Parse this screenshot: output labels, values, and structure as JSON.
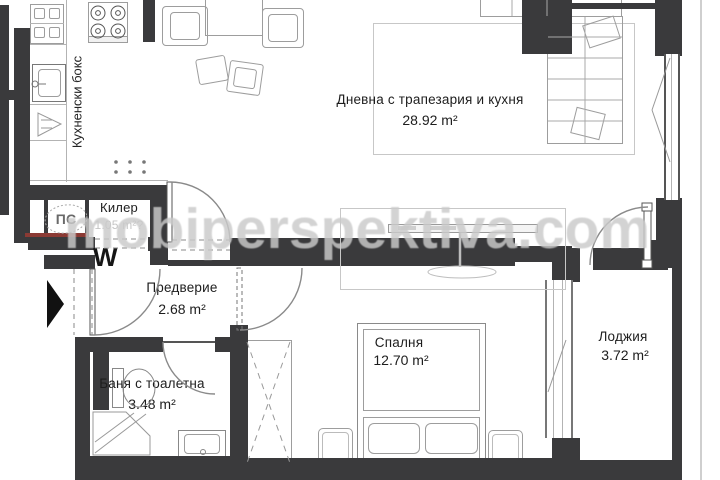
{
  "plan": {
    "watermark": "mobiperspektiva.com",
    "rooms": {
      "living": {
        "label": "Дневна с трапезария и кухня",
        "area": "28.92 m²"
      },
      "kitchenette": {
        "label": "Кухненски бокс",
        "area": ""
      },
      "closet": {
        "label": "Килер",
        "area": "1.05 m²?"
      },
      "hall": {
        "label": "Предверие",
        "area": "2.68 m²"
      },
      "bathroom": {
        "label": "Баня с тоалетна",
        "area": "3.48 m²"
      },
      "bedroom": {
        "label": "Спалня",
        "area": "12.70 m²"
      },
      "loggia": {
        "label": "Лоджия",
        "area": "3.72 m²"
      }
    },
    "annotations": {
      "shaft": "ПС",
      "washer": "W"
    },
    "colors": {
      "wall": "#3a3a3c",
      "accent_red": "#8b3a34",
      "furniture_line": "#9d9d9d",
      "watermark": "#cacaca"
    }
  }
}
